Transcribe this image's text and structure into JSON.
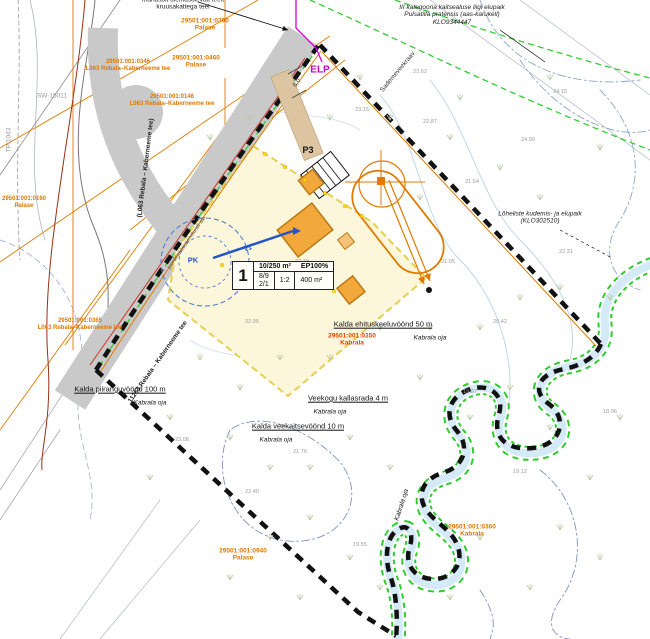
{
  "colors": {
    "road_gray": "#c9c9c9",
    "boundary_black": "#111111",
    "plot_fill": "#fcf6da",
    "plot_edge_yellow": "#e6cf4e",
    "building_fill": "#f3a83c",
    "building_edge": "#b97a14",
    "stream_fill": "#d4eaf7",
    "green_zone": "#33cc33",
    "survey_orange": "#e07800",
    "magenta": "#cc00cc",
    "well_blue": "#2255cc",
    "red_line": "#cc3320"
  },
  "plot_table": {
    "pos": "1",
    "area": "10/250 m²",
    "intensity": "EP100%",
    "floors": "8/9",
    "buildings": "2/1",
    "ratio": "1:2",
    "footprint": "400 m²"
  },
  "labels": [
    {
      "name": "note-access",
      "x": 183,
      "y": 4,
      "lines": [
        "mahasõit olemasolevalt teelt",
        "kruusakattega teel"
      ],
      "size": 6.5,
      "color": "#1a1a1a"
    },
    {
      "name": "cad-label-palase-0390",
      "x": 205,
      "y": 25,
      "lines": [
        "29501:001:0390",
        "Palase"
      ],
      "color": "#e07800",
      "size": 6.5,
      "bold": true
    },
    {
      "name": "cad-label-palase-0460",
      "x": 196,
      "y": 62,
      "lines": [
        "29501:001:0460",
        "Palase"
      ],
      "color": "#e07800",
      "size": 6.5,
      "bold": true
    },
    {
      "name": "cad-label-road-0346",
      "x": 128,
      "y": 66,
      "lines": [
        "29501:001:0346",
        "L063 Rebala–Kaberneeme tee"
      ],
      "color": "#e07800",
      "size": 6,
      "bold": true
    },
    {
      "name": "cad-label-road-0146",
      "x": 172,
      "y": 101,
      "lines": [
        "29501:001:0146",
        "L063 Rebala–Kaberneeme tee"
      ],
      "color": "#e07800",
      "size": 6,
      "bold": true
    },
    {
      "name": "cad-label-road-0365",
      "x": 80,
      "y": 325,
      "lines": [
        "29501:001:0365",
        "L063 Rebala–Kaberneeme tee"
      ],
      "color": "#e07800",
      "size": 6,
      "bold": true
    },
    {
      "name": "cad-label-palase-0160",
      "x": 24,
      "y": 203,
      "lines": [
        "29501:001:0160",
        "Palase"
      ],
      "color": "#e07800",
      "size": 6,
      "bold": true
    },
    {
      "name": "cad-label-kabrala-0360",
      "x": 472,
      "y": 531,
      "lines": [
        "29501:001:0360",
        "Kabrala"
      ],
      "color": "#e07800",
      "size": 6.5,
      "bold": true
    },
    {
      "name": "cad-label-palase-0940",
      "x": 243,
      "y": 555,
      "lines": [
        "29501:001:0940",
        "Palase"
      ],
      "color": "#e07800",
      "size": 6.5,
      "bold": true
    },
    {
      "name": "cad-label-kabrala-0350",
      "x": 352,
      "y": 340,
      "lines": [
        "29501:001:0350",
        "Kabrala"
      ],
      "color": "#e84000",
      "size": 6.5,
      "bold": true
    },
    {
      "name": "note-protected-species",
      "x": 452,
      "y": 15,
      "lines": [
        "III kategooria kaitsealuse liigi elupaik",
        "Pulsatilla pratensis (aas-karukell)",
        "KLO9344447"
      ],
      "size": 6.5,
      "italic": true,
      "color": "#222"
    },
    {
      "name": "label-ditch",
      "x": 398,
      "y": 72,
      "lines": [
        "Sademeveekraav"
      ],
      "size": 6.5,
      "rot": -50,
      "color": "#333"
    },
    {
      "name": "label-elp",
      "x": 320,
      "y": 70,
      "lines": [
        "ELP"
      ],
      "size": 10,
      "bold": true,
      "color": "#cc00cc"
    },
    {
      "name": "road-name-branch",
      "x": 146,
      "y": 168,
      "lines": [
        "(L063 Rebala – Kaberneeme tee)"
      ],
      "size": 6.5,
      "rot": -83,
      "color": "#222",
      "bold": true
    },
    {
      "name": "road-name-main",
      "x": 158,
      "y": 362,
      "lines": [
        "11263 Rebala – Kaberneeme tee"
      ],
      "size": 6.5,
      "rot": -55,
      "color": "#222",
      "bold": true
    },
    {
      "name": "label-access-servitude",
      "x": 187,
      "y": 243,
      "lines": [
        "juurdepääsuservituudi ala"
      ],
      "size": 5.5,
      "rot": -55,
      "color": "#555"
    },
    {
      "name": "label-sw",
      "x": 52,
      "y": 96,
      "lines": [
        "SW-15011"
      ],
      "size": 6.5,
      "color": "#999999"
    },
    {
      "name": "label-tp",
      "x": 9,
      "y": 140,
      "lines": [
        "TP/1043"
      ],
      "size": 6.5,
      "rot": -90,
      "color": "#999999"
    },
    {
      "name": "label-p3",
      "x": 308,
      "y": 150,
      "lines": [
        "P3"
      ],
      "size": 9,
      "bold": true,
      "color": "#111"
    },
    {
      "name": "label-pk",
      "x": 193,
      "y": 261,
      "lines": [
        "PK"
      ],
      "size": 7.5,
      "bold": true,
      "color": "#2255cc"
    },
    {
      "name": "label-v1",
      "x": 248,
      "y": 249,
      "lines": [
        "V1"
      ],
      "size": 6.5,
      "rot": -20,
      "bold": true,
      "color": "#2255cc"
    },
    {
      "name": "dim-road-width",
      "x": 297,
      "y": 83,
      "lines": [
        "6.0"
      ],
      "size": 6.5,
      "rot": -55,
      "color": "#444"
    },
    {
      "name": "label-building-exclusion",
      "x": 383,
      "y": 325,
      "lines": [
        "Kalda ehituskeeluvöönd 50 m"
      ],
      "size": 7.5,
      "underline": true,
      "color": "#111"
    },
    {
      "name": "label-building-exclusion-stream",
      "x": 430,
      "y": 338,
      "lines": [
        "Kabrala oja"
      ],
      "size": 6.5,
      "italic": true,
      "color": "#111"
    },
    {
      "name": "label-shore-path",
      "x": 348,
      "y": 399,
      "lines": [
        "Veekogu kallasrada 4 m"
      ],
      "size": 7.5,
      "underline": true,
      "color": "#111"
    },
    {
      "name": "label-shore-path-stream",
      "x": 330,
      "y": 412,
      "lines": [
        "Kabrala oja"
      ],
      "size": 6.5,
      "italic": true,
      "color": "#111"
    },
    {
      "name": "label-water-protection",
      "x": 298,
      "y": 427,
      "lines": [
        "Kalda veekaitsevöönd 10 m"
      ],
      "size": 7.5,
      "underline": true,
      "color": "#111"
    },
    {
      "name": "label-water-protection-stream",
      "x": 276,
      "y": 440,
      "lines": [
        "Kabrala oja"
      ],
      "size": 6.5,
      "italic": true,
      "color": "#111"
    },
    {
      "name": "label-restriction-zone",
      "x": 120,
      "y": 390,
      "lines": [
        "Kalda piiranguvöönd 100 m"
      ],
      "size": 7.5,
      "underline": true,
      "color": "#111"
    },
    {
      "name": "label-restriction-zone-stream",
      "x": 150,
      "y": 403,
      "lines": [
        "Kabrala oja"
      ],
      "size": 6.5,
      "italic": true,
      "color": "#111"
    },
    {
      "name": "label-salmonid-habitat",
      "x": 540,
      "y": 218,
      "lines": [
        "Lõheliste kudemis- ja elupaik",
        "(KLO302510)"
      ],
      "size": 6.5,
      "italic": true,
      "color": "#222"
    },
    {
      "name": "stream-name",
      "x": 402,
      "y": 505,
      "lines": [
        "Kabrala oja"
      ],
      "size": 6.5,
      "italic": true,
      "rot": -72,
      "color": "#111"
    }
  ],
  "spot_heights": [
    [
      362,
      110,
      "23.15"
    ],
    [
      430,
      122,
      "22.87"
    ],
    [
      472,
      182,
      "21.64"
    ],
    [
      528,
      140,
      "24.90"
    ],
    [
      566,
      252,
      "22.31"
    ],
    [
      448,
      262,
      "21.05"
    ],
    [
      500,
      322,
      "20.42"
    ],
    [
      470,
      392,
      "19.87"
    ],
    [
      520,
      472,
      "19.12"
    ],
    [
      300,
      452,
      "21.76"
    ],
    [
      252,
      492,
      "22.40"
    ],
    [
      360,
      545,
      "19.55"
    ],
    [
      182,
      440,
      "23.08"
    ],
    [
      420,
      72,
      "23.62"
    ],
    [
      252,
      322,
      "22.95"
    ],
    [
      302,
      262,
      "22.18"
    ],
    [
      560,
      92,
      "24.15"
    ],
    [
      610,
      412,
      "18.96"
    ]
  ]
}
